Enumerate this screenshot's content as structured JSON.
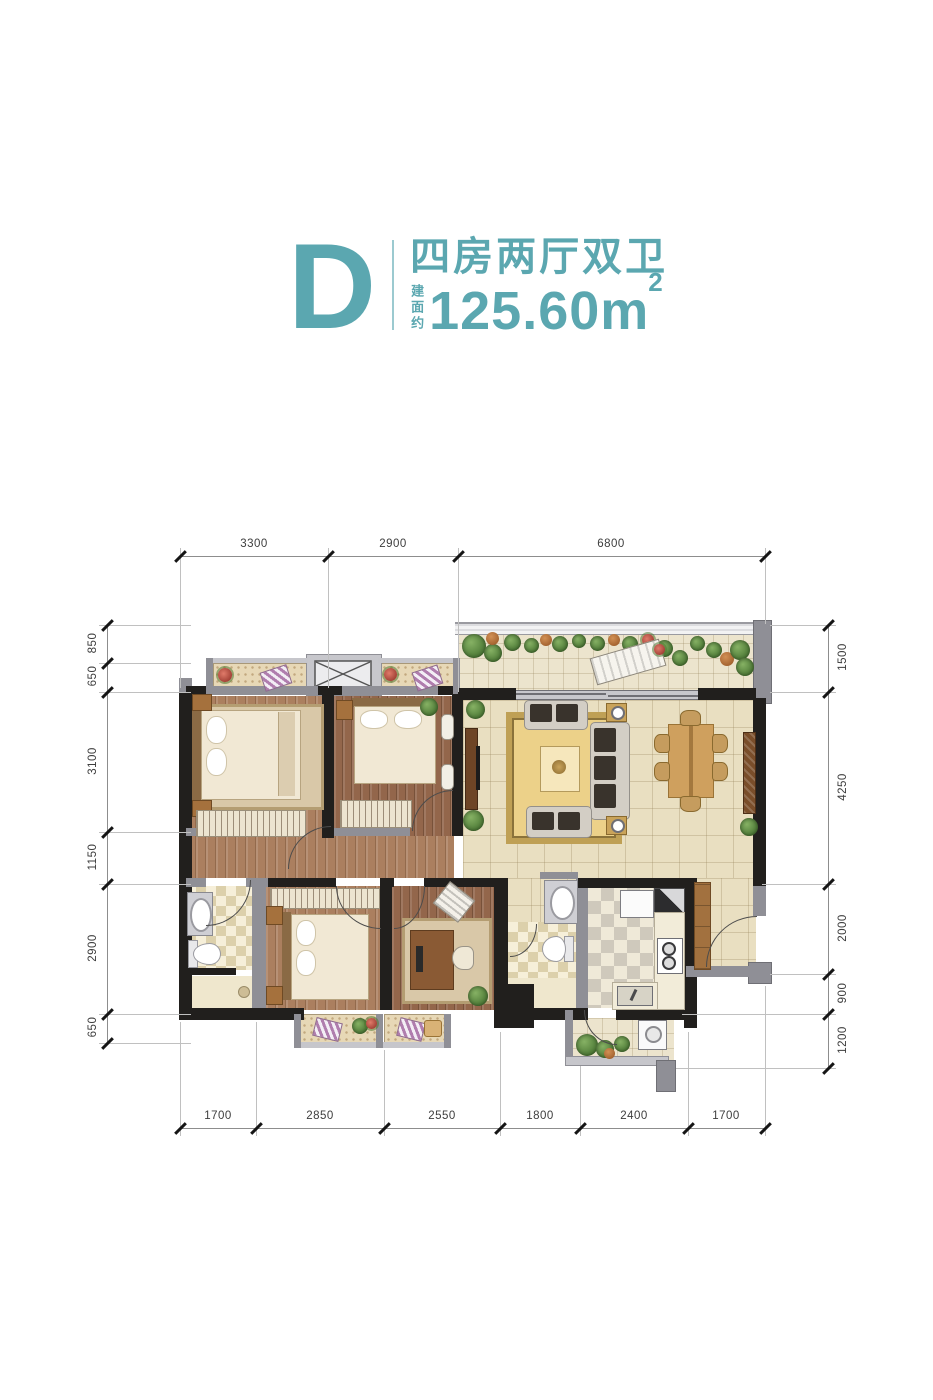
{
  "title": {
    "letter": "D",
    "layout_name": "四房两厅双卫",
    "area_label": "建面约",
    "area_value": "125.60",
    "area_unit": "m",
    "area_exponent": "2"
  },
  "dimensions": {
    "top": [
      "3300",
      "2900",
      "6800"
    ],
    "bottom": [
      "1700",
      "2850",
      "2550",
      "1800",
      "2400",
      "1700"
    ],
    "left": [
      "850",
      "650",
      "3100",
      "1150",
      "2900",
      "650"
    ],
    "right": [
      "1500",
      "4250",
      "2000",
      "900",
      "1200"
    ]
  },
  "colors": {
    "accent": "#5ba7b0",
    "divider": "#9ccad0",
    "wall_dark": "#211f1d",
    "wall_gray": "#8f8f96",
    "floor_tile": "#e9dfc1",
    "floor_wood": "#ab7f5f"
  }
}
